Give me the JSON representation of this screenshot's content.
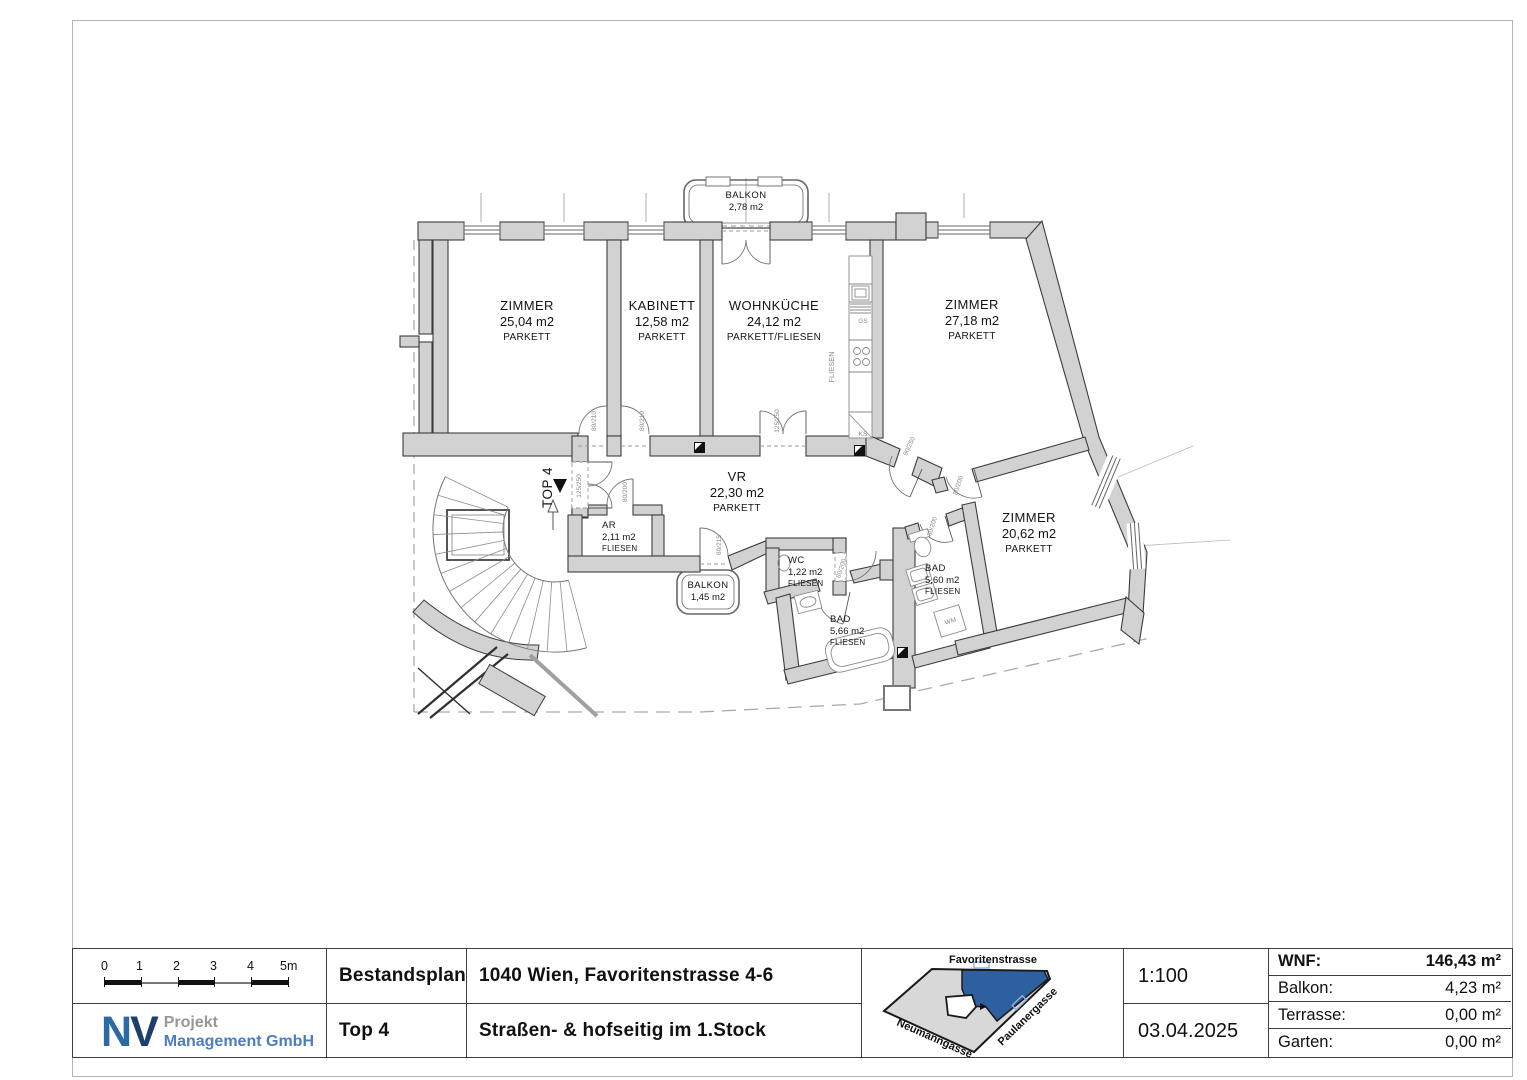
{
  "plan": {
    "entrance": {
      "label": "TOP 4"
    },
    "rooms": [
      {
        "name": "BALKON",
        "area": "2,78 m2",
        "floor": "",
        "x": 746,
        "y": 198,
        "anchor": "middle",
        "size": "small"
      },
      {
        "name": "ZIMMER",
        "area": "25,04 m2",
        "floor": "PARKETT",
        "x": 527,
        "y": 310,
        "anchor": "middle",
        "size": "normal"
      },
      {
        "name": "KABINETT",
        "area": "12,58 m2",
        "floor": "PARKETT",
        "x": 662,
        "y": 310,
        "anchor": "middle",
        "size": "normal"
      },
      {
        "name": "WOHNKÜCHE",
        "area": "24,12 m2",
        "floor": "PARKETT/FLIESEN",
        "x": 774,
        "y": 310,
        "anchor": "middle",
        "size": "normal"
      },
      {
        "name": "ZIMMER",
        "area": "27,18 m2",
        "floor": "PARKETT",
        "x": 972,
        "y": 309,
        "anchor": "middle",
        "size": "normal"
      },
      {
        "name": "VR",
        "area": "22,30 m2",
        "floor": "PARKETT",
        "x": 737,
        "y": 481,
        "anchor": "middle",
        "size": "normal"
      },
      {
        "name": "AR",
        "area": "2,11 m2",
        "floor": "FLIESEN",
        "x": 602,
        "y": 528,
        "anchor": "start",
        "size": "small"
      },
      {
        "name": "BALKON",
        "area": "1,45 m2",
        "floor": "",
        "x": 708,
        "y": 588,
        "anchor": "middle",
        "size": "small"
      },
      {
        "name": "WC",
        "area": "1,22 m2",
        "floor": "FLIESEN",
        "x": 788,
        "y": 563,
        "anchor": "start",
        "size": "small"
      },
      {
        "name": "BAD",
        "area": "5,66 m2",
        "floor": "FLIESEN",
        "x": 830,
        "y": 622,
        "anchor": "start",
        "size": "small"
      },
      {
        "name": "BAD",
        "area": "5,60 m2",
        "floor": "FLIESEN",
        "x": 925,
        "y": 571,
        "anchor": "start",
        "size": "small"
      },
      {
        "name": "ZIMMER",
        "area": "20,62 m2",
        "floor": "PARKETT",
        "x": 1029,
        "y": 522,
        "anchor": "middle",
        "size": "normal"
      }
    ],
    "annotations": [
      {
        "text": "80/210",
        "x": 596,
        "y": 421,
        "rot": -90
      },
      {
        "text": "80/210",
        "x": 644,
        "y": 421,
        "rot": -90
      },
      {
        "text": "125/250",
        "x": 779,
        "y": 421,
        "rot": -90
      },
      {
        "text": "90/250",
        "x": 911,
        "y": 447,
        "rot": -65
      },
      {
        "text": "125/250",
        "x": 581,
        "y": 486,
        "rot": -90
      },
      {
        "text": "80/200",
        "x": 627,
        "y": 492,
        "rot": -90
      },
      {
        "text": "80/215",
        "x": 721,
        "y": 545,
        "rot": -90
      },
      {
        "text": "80/200",
        "x": 843,
        "y": 569,
        "rot": -72
      },
      {
        "text": "80/200",
        "x": 934,
        "y": 527,
        "rot": -72
      },
      {
        "text": "80/200",
        "x": 960,
        "y": 486,
        "rot": -72
      },
      {
        "text": "GS",
        "x": 863,
        "y": 323,
        "rot": 0
      },
      {
        "text": "KS",
        "x": 863,
        "y": 436,
        "rot": 0
      },
      {
        "text": "WM",
        "x": 951,
        "y": 623,
        "rot": -17
      },
      {
        "text": "FLIESEN",
        "x": 834,
        "y": 367,
        "rot": -90,
        "size": 7.5
      }
    ]
  },
  "titleblock": {
    "scalebar": {
      "labels": [
        "0",
        "1",
        "2",
        "3",
        "4",
        "5m"
      ]
    },
    "plan_type": "Bestandsplan",
    "unit": "Top 4",
    "address": "1040 Wien, Favoritenstrasse 4-6",
    "location": "Straßen- & hofseitig im 1.Stock",
    "scale": "1:100",
    "date": "03.04.2025",
    "logo": {
      "n": "N",
      "v": "V",
      "line1": "Projekt",
      "line2": "Management GmbH"
    },
    "sitemap": {
      "streets": [
        "Favoritenstrasse",
        "Neumanngasse",
        "Paulanergasse"
      ],
      "highlight_color": "#2e5f9e",
      "footprint_color": "#d8d8d8"
    },
    "areas": [
      {
        "label": "WNF:",
        "value": "146,43 m²"
      },
      {
        "label": "Balkon:",
        "value": "4,23 m²"
      },
      {
        "label": "Terrasse:",
        "value": "0,00 m²"
      },
      {
        "label": "Garten:",
        "value": "0,00 m²"
      }
    ]
  }
}
